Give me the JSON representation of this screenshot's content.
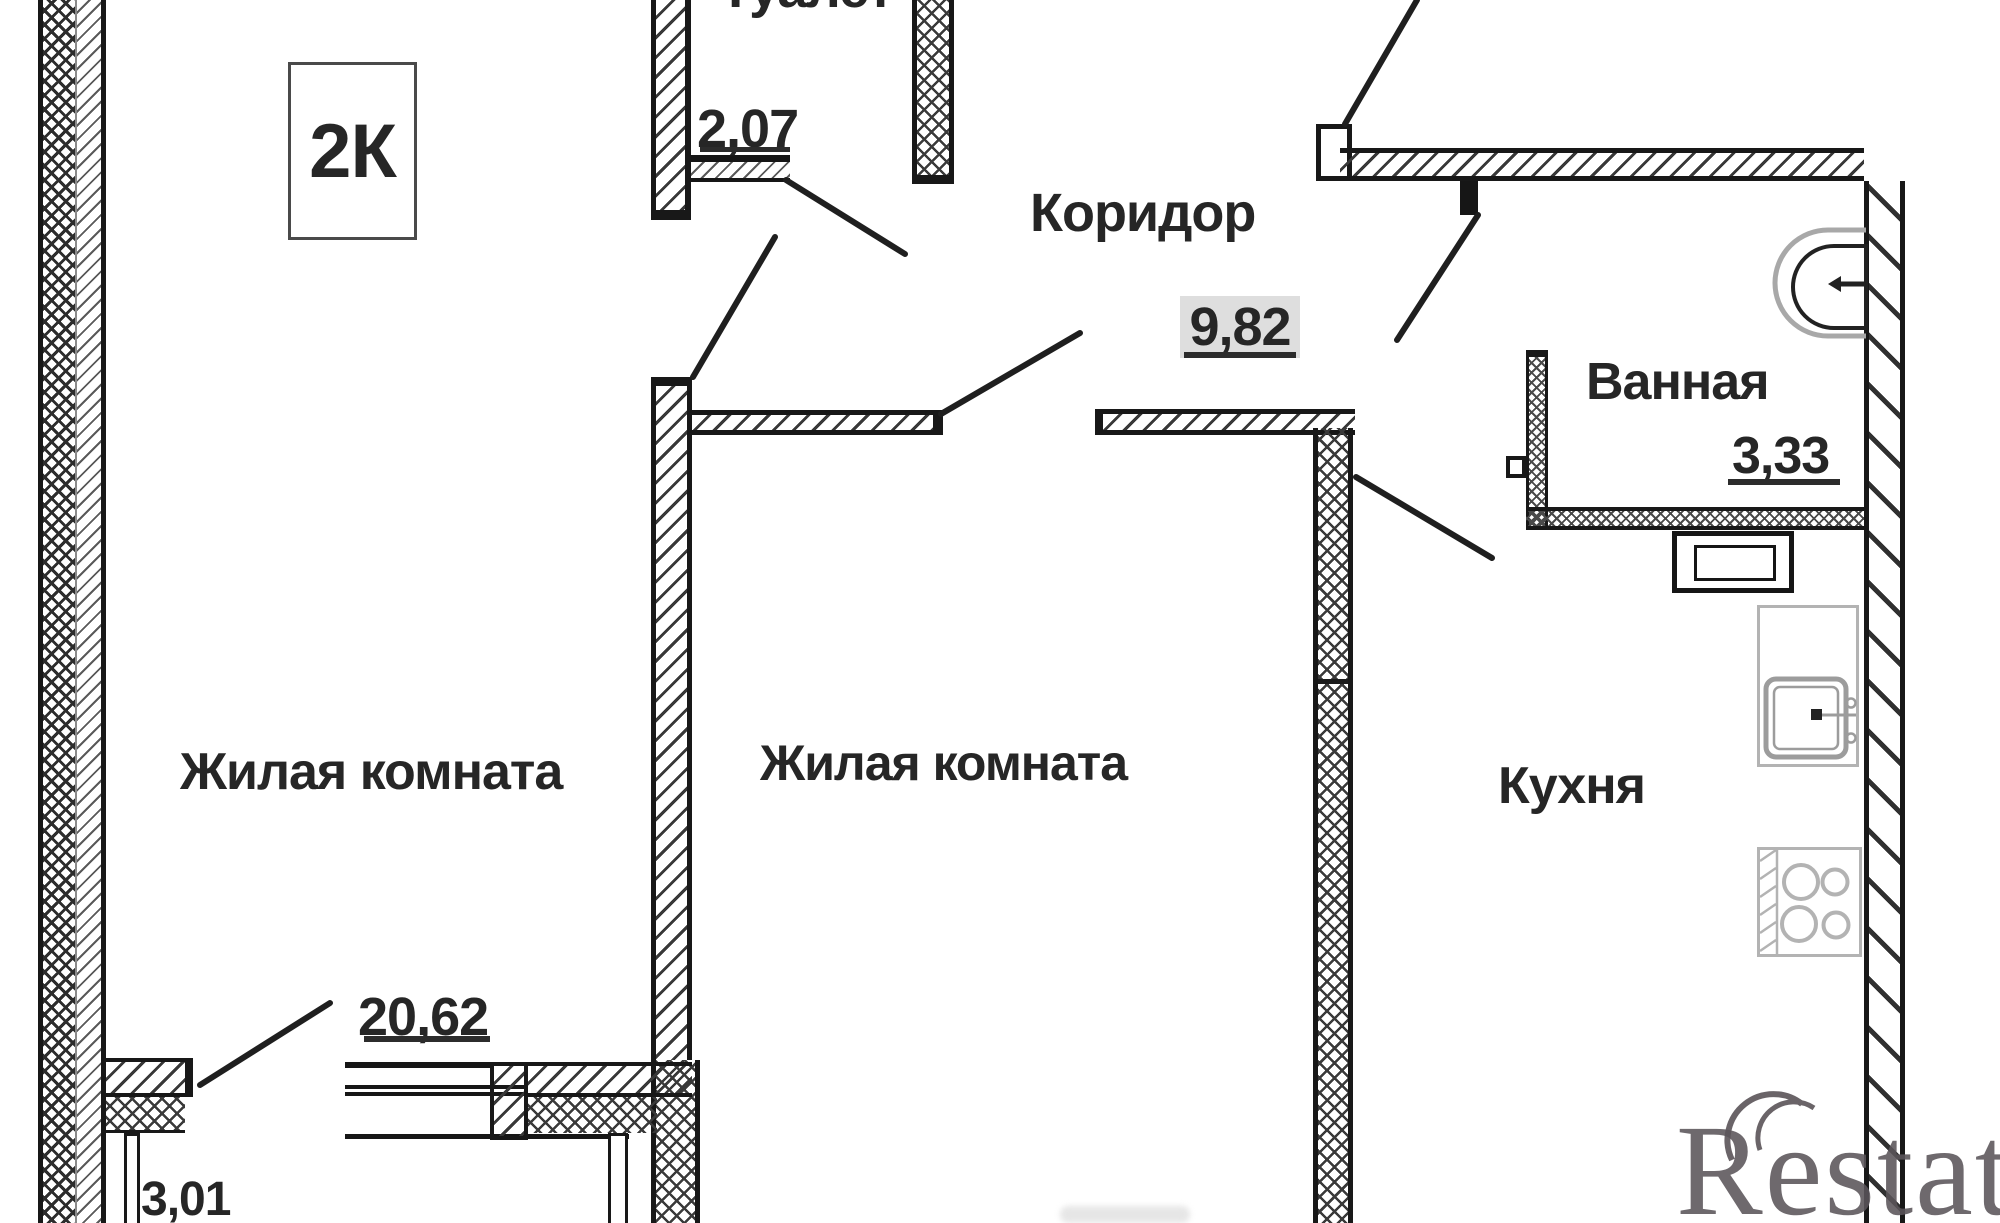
{
  "badge": {
    "label": "2К"
  },
  "rooms": {
    "toilet": {
      "name": "Туалет",
      "area": "2,07"
    },
    "corridor": {
      "name": "Коридор",
      "area": "9,82"
    },
    "bathroom": {
      "name": "Ванная",
      "area": "3,33"
    },
    "kitchen": {
      "name": "Кухня"
    },
    "living_left": {
      "name": "Жилая комната",
      "area": "20,62"
    },
    "living_center": {
      "name": "Жилая комната"
    },
    "balcony": {
      "area": "3,01"
    }
  },
  "watermark": {
    "text": "Restate"
  },
  "colors": {
    "wall": "#1c1c1c",
    "area_badge_bg": "#dedede",
    "fixture_gray": "#a8a8a8",
    "watermark_gray": "#5b555a"
  }
}
